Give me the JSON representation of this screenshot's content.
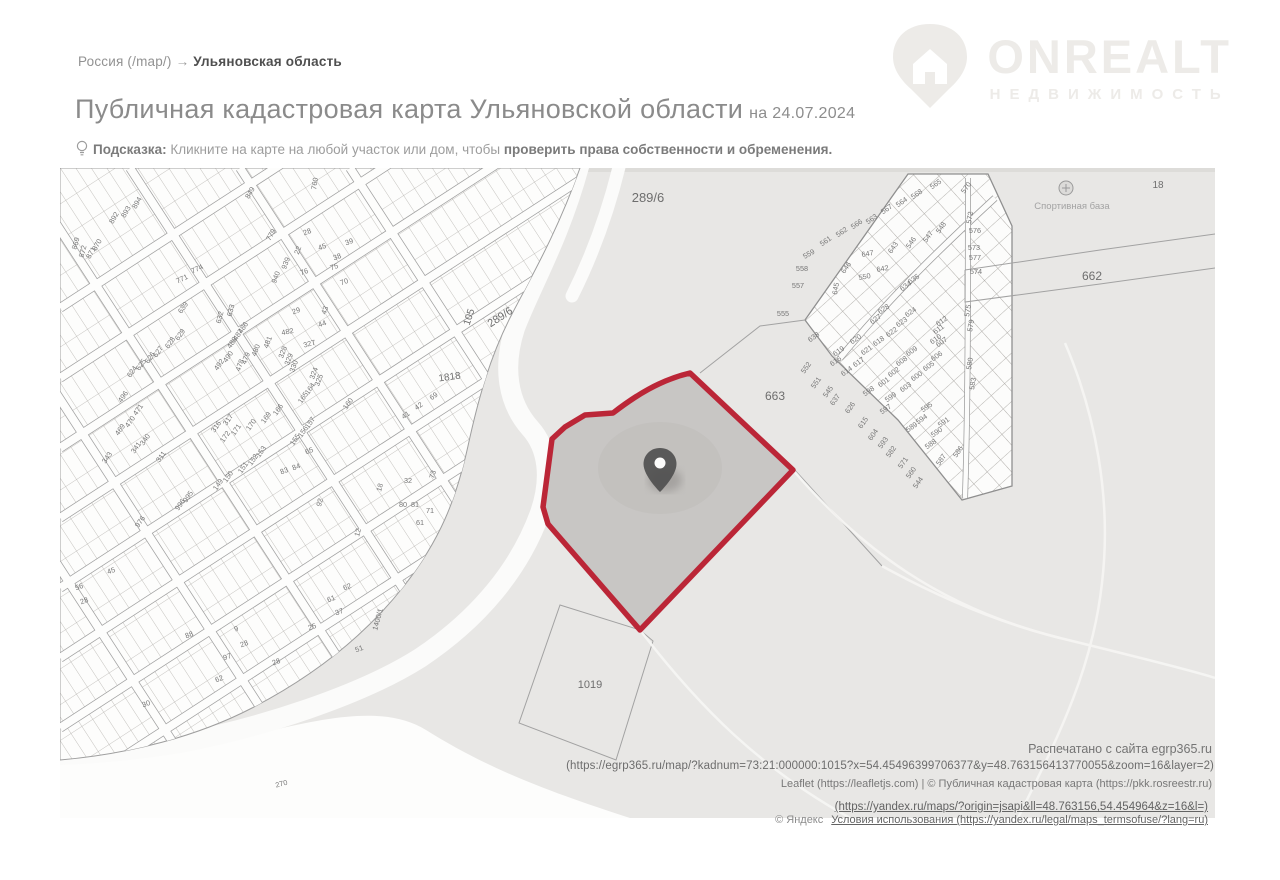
{
  "breadcrumb": {
    "root": "Россия (/map/)",
    "arrow": "→",
    "current": "Ульяновская область"
  },
  "logo": {
    "name": "ONREALT",
    "subtitle": "НЕДВИЖИМОСТЬ",
    "color": "#edebe8"
  },
  "title": {
    "main": "Публичная кадастровая карта Ульяновской области",
    "date_suffix": "на 24.07.2024"
  },
  "hint": {
    "label": "Подсказка:",
    "text_regular": " Кликните на карте на любой участок или дом, чтобы ",
    "text_bold": "проверить права собственности и обременения."
  },
  "map": {
    "colors": {
      "highlight_stroke": "#bb2637",
      "highlight_fill": "#c8c6c4",
      "field_gray": "#e8e7e5",
      "line_gray": "#a8a8a8",
      "label_gray": "#767676"
    },
    "footer": {
      "printed": "Распечатано с сайта egrp365.ru",
      "url": "(https://egrp365.ru/map/?kadnum=73:21:000000:1015?x=54.45496399706377&y=48.763156413770055&zoom=16&layer=2)",
      "leaflet": "Leaflet (https://leafletjs.com) | © Публичная кадастровая карта (https://pkk.rosreestr.ru)"
    },
    "labels_large": [
      {
        "t": "289/6",
        "x": 588,
        "y": 34,
        "s": 13
      },
      {
        "t": "289/6",
        "x": 442,
        "y": 152,
        "s": 11,
        "r": -33
      },
      {
        "t": "105",
        "x": 412,
        "y": 150,
        "s": 10,
        "r": -72
      },
      {
        "t": "1818",
        "x": 390,
        "y": 212,
        "s": 10,
        "r": -8
      },
      {
        "t": "663",
        "x": 715,
        "y": 232,
        "s": 12
      },
      {
        "t": "662",
        "x": 1032,
        "y": 112,
        "s": 12
      },
      {
        "t": "1019",
        "x": 530,
        "y": 520,
        "s": 11
      },
      {
        "t": "18",
        "x": 1098,
        "y": 20,
        "s": 10
      },
      {
        "t": "Спортивная база",
        "x": 1012,
        "y": 41,
        "s": 9.5,
        "c": "#a3a3a3"
      }
    ],
    "parcel_labels": [
      {
        "t": "894",
        "x": 79,
        "y": 36,
        "r": -60
      },
      {
        "t": "893",
        "x": 68,
        "y": 45,
        "r": -60
      },
      {
        "t": "892",
        "x": 56,
        "y": 51,
        "r": -60
      },
      {
        "t": "870",
        "x": 39,
        "y": 78,
        "r": -60
      },
      {
        "t": "871",
        "x": 33,
        "y": 86,
        "r": -60
      },
      {
        "t": "872",
        "x": 25,
        "y": 84,
        "r": -75
      },
      {
        "t": "869",
        "x": 18,
        "y": 76,
        "r": -75
      },
      {
        "t": "849",
        "x": 192,
        "y": 26,
        "r": -60
      },
      {
        "t": "779",
        "x": 213,
        "y": 68,
        "r": -60
      },
      {
        "t": "760",
        "x": 257,
        "y": 16,
        "r": -80
      },
      {
        "t": "774",
        "x": 138,
        "y": 103,
        "r": -25
      },
      {
        "t": "771",
        "x": 123,
        "y": 113,
        "r": -25
      },
      {
        "t": "639",
        "x": 125,
        "y": 141,
        "r": -55
      },
      {
        "t": "633",
        "x": 173,
        "y": 143,
        "r": -75
      },
      {
        "t": "632",
        "x": 162,
        "y": 150,
        "r": -75
      },
      {
        "t": "486",
        "x": 185,
        "y": 161,
        "r": -55
      },
      {
        "t": "487",
        "x": 180,
        "y": 168,
        "r": -55
      },
      {
        "t": "488",
        "x": 174,
        "y": 176,
        "r": -55
      },
      {
        "t": "629",
        "x": 122,
        "y": 168,
        "r": -55
      },
      {
        "t": "628",
        "x": 112,
        "y": 176,
        "r": -55
      },
      {
        "t": "627",
        "x": 100,
        "y": 185,
        "r": -55
      },
      {
        "t": "626",
        "x": 92,
        "y": 191,
        "r": -55
      },
      {
        "t": "625",
        "x": 83,
        "y": 198,
        "r": -55
      },
      {
        "t": "624",
        "x": 74,
        "y": 205,
        "r": -55
      },
      {
        "t": "490",
        "x": 170,
        "y": 190,
        "r": -55
      },
      {
        "t": "492",
        "x": 161,
        "y": 198,
        "r": -55
      },
      {
        "t": "482",
        "x": 228,
        "y": 166,
        "r": -12
      },
      {
        "t": "481",
        "x": 210,
        "y": 175,
        "r": -70
      },
      {
        "t": "480",
        "x": 198,
        "y": 183,
        "r": -70
      },
      {
        "t": "479",
        "x": 188,
        "y": 191,
        "r": -70
      },
      {
        "t": "478",
        "x": 182,
        "y": 198,
        "r": -70
      },
      {
        "t": "327",
        "x": 250,
        "y": 178,
        "r": -15
      },
      {
        "t": "328",
        "x": 225,
        "y": 185,
        "r": -70
      },
      {
        "t": "329",
        "x": 231,
        "y": 192,
        "r": -70
      },
      {
        "t": "330",
        "x": 236,
        "y": 199,
        "r": -70
      },
      {
        "t": "324",
        "x": 256,
        "y": 206,
        "r": -70
      },
      {
        "t": "325",
        "x": 261,
        "y": 213,
        "r": -70
      },
      {
        "t": "939",
        "x": 228,
        "y": 96,
        "r": -70
      },
      {
        "t": "940",
        "x": 218,
        "y": 110,
        "r": -70
      },
      {
        "t": "22",
        "x": 240,
        "y": 83,
        "r": -70
      },
      {
        "t": "28",
        "x": 248,
        "y": 66,
        "r": -20
      },
      {
        "t": "45",
        "x": 263,
        "y": 81,
        "r": -20
      },
      {
        "t": "38",
        "x": 278,
        "y": 91,
        "r": -20
      },
      {
        "t": "39",
        "x": 290,
        "y": 76,
        "r": -20
      },
      {
        "t": "75",
        "x": 275,
        "y": 101,
        "r": -20
      },
      {
        "t": "70",
        "x": 285,
        "y": 116,
        "r": -20
      },
      {
        "t": "76",
        "x": 245,
        "y": 106,
        "r": -20
      },
      {
        "t": "29",
        "x": 237,
        "y": 145,
        "r": -20
      },
      {
        "t": "43",
        "x": 267,
        "y": 143,
        "r": -70
      },
      {
        "t": "44",
        "x": 263,
        "y": 158,
        "r": -20
      },
      {
        "t": "496",
        "x": 65,
        "y": 230,
        "r": -55
      },
      {
        "t": "471",
        "x": 80,
        "y": 243,
        "r": -55
      },
      {
        "t": "470",
        "x": 72,
        "y": 255,
        "r": -55
      },
      {
        "t": "469",
        "x": 62,
        "y": 263,
        "r": -55
      },
      {
        "t": "341",
        "x": 78,
        "y": 281,
        "r": -55
      },
      {
        "t": "340",
        "x": 87,
        "y": 273,
        "r": -55
      },
      {
        "t": "343",
        "x": 49,
        "y": 291,
        "r": -55
      },
      {
        "t": "311",
        "x": 103,
        "y": 290,
        "r": -55
      },
      {
        "t": "317",
        "x": 170,
        "y": 253,
        "r": -55
      },
      {
        "t": "316",
        "x": 158,
        "y": 260,
        "r": -55
      },
      {
        "t": "172",
        "x": 167,
        "y": 270,
        "r": -55
      },
      {
        "t": "171",
        "x": 178,
        "y": 263,
        "r": -55
      },
      {
        "t": "170",
        "x": 193,
        "y": 258,
        "r": -55
      },
      {
        "t": "169",
        "x": 208,
        "y": 251,
        "r": -55
      },
      {
        "t": "166",
        "x": 220,
        "y": 243,
        "r": -55
      },
      {
        "t": "165",
        "x": 245,
        "y": 231,
        "r": -55
      },
      {
        "t": "164",
        "x": 252,
        "y": 222,
        "r": -55
      },
      {
        "t": "160",
        "x": 290,
        "y": 237,
        "r": -55
      },
      {
        "t": "157",
        "x": 252,
        "y": 256,
        "r": -55
      },
      {
        "t": "156",
        "x": 245,
        "y": 265,
        "r": -55
      },
      {
        "t": "155",
        "x": 237,
        "y": 273,
        "r": -55
      },
      {
        "t": "153",
        "x": 203,
        "y": 285,
        "r": -55
      },
      {
        "t": "152",
        "x": 195,
        "y": 293,
        "r": -55
      },
      {
        "t": "151",
        "x": 185,
        "y": 301,
        "r": -55
      },
      {
        "t": "150",
        "x": 170,
        "y": 310,
        "r": -55
      },
      {
        "t": "149",
        "x": 160,
        "y": 318,
        "r": -55
      },
      {
        "t": "995",
        "x": 130,
        "y": 330,
        "r": -55
      },
      {
        "t": "996",
        "x": 122,
        "y": 338,
        "r": -55
      },
      {
        "t": "976",
        "x": 82,
        "y": 355,
        "r": -55
      },
      {
        "t": "83",
        "x": 225,
        "y": 305,
        "r": -20
      },
      {
        "t": "84",
        "x": 237,
        "y": 301,
        "r": -20
      },
      {
        "t": "92",
        "x": 262,
        "y": 335,
        "r": -75
      },
      {
        "t": "65",
        "x": 250,
        "y": 285,
        "r": -20
      },
      {
        "t": "12",
        "x": 300,
        "y": 365,
        "r": -75
      },
      {
        "t": "18",
        "x": 322,
        "y": 320,
        "r": -75
      },
      {
        "t": "41",
        "x": 347,
        "y": 249,
        "r": -35
      },
      {
        "t": "42",
        "x": 360,
        "y": 240,
        "r": -35
      },
      {
        "t": "69",
        "x": 375,
        "y": 230,
        "r": -35
      },
      {
        "t": "73",
        "x": 375,
        "y": 307,
        "r": -75
      },
      {
        "t": "32",
        "x": 348,
        "y": 315
      },
      {
        "t": "80",
        "x": 343,
        "y": 339
      },
      {
        "t": "81",
        "x": 355,
        "y": 339
      },
      {
        "t": "71",
        "x": 370,
        "y": 345
      },
      {
        "t": "61",
        "x": 360,
        "y": 357
      },
      {
        "t": "45",
        "x": 52,
        "y": 405,
        "r": -20
      },
      {
        "t": "56",
        "x": 20,
        "y": 421,
        "r": -20
      },
      {
        "t": "28",
        "x": 25,
        "y": 435,
        "r": -20
      },
      {
        "t": "62",
        "x": 288,
        "y": 421,
        "r": -20
      },
      {
        "t": "61",
        "x": 272,
        "y": 433,
        "r": -20
      },
      {
        "t": "37",
        "x": 280,
        "y": 446,
        "r": -20
      },
      {
        "t": "25",
        "x": 253,
        "y": 461,
        "r": -20
      },
      {
        "t": "51",
        "x": 300,
        "y": 483,
        "r": -20
      },
      {
        "t": "1400/1",
        "x": 320,
        "y": 452,
        "r": -75
      },
      {
        "t": "97",
        "x": 168,
        "y": 491,
        "r": -20
      },
      {
        "t": "62",
        "x": 160,
        "y": 513,
        "r": -20
      },
      {
        "t": "30",
        "x": 87,
        "y": 538,
        "r": -20
      },
      {
        "t": "28",
        "x": 185,
        "y": 478,
        "r": -20
      },
      {
        "t": "9",
        "x": 177,
        "y": 463,
        "r": -20
      },
      {
        "t": "28",
        "x": 217,
        "y": 496,
        "r": -20
      },
      {
        "t": "88",
        "x": 130,
        "y": 469,
        "r": -20
      },
      {
        "t": "270",
        "x": 222,
        "y": 618,
        "r": -15
      },
      {
        "t": "565",
        "x": 877,
        "y": 18,
        "r": -35
      },
      {
        "t": "568",
        "x": 858,
        "y": 28,
        "r": -35
      },
      {
        "t": "564",
        "x": 843,
        "y": 36,
        "r": -35
      },
      {
        "t": "567",
        "x": 828,
        "y": 43,
        "r": -35
      },
      {
        "t": "563",
        "x": 813,
        "y": 53,
        "r": -35
      },
      {
        "t": "566",
        "x": 798,
        "y": 58,
        "r": -35
      },
      {
        "t": "562",
        "x": 783,
        "y": 66,
        "r": -35
      },
      {
        "t": "561",
        "x": 767,
        "y": 75,
        "r": -35
      },
      {
        "t": "559",
        "x": 750,
        "y": 88,
        "r": -30
      },
      {
        "t": "558",
        "x": 742,
        "y": 103
      },
      {
        "t": "557",
        "x": 738,
        "y": 120
      },
      {
        "t": "555",
        "x": 723,
        "y": 148
      },
      {
        "t": "548",
        "x": 883,
        "y": 61,
        "r": -55
      },
      {
        "t": "547",
        "x": 870,
        "y": 70,
        "r": -55
      },
      {
        "t": "546",
        "x": 853,
        "y": 76,
        "r": -55
      },
      {
        "t": "643",
        "x": 835,
        "y": 81,
        "r": -55
      },
      {
        "t": "647",
        "x": 808,
        "y": 88,
        "r": -10
      },
      {
        "t": "646",
        "x": 788,
        "y": 101,
        "r": -55
      },
      {
        "t": "642",
        "x": 823,
        "y": 103,
        "r": -10
      },
      {
        "t": "550",
        "x": 805,
        "y": 111,
        "r": -10
      },
      {
        "t": "645",
        "x": 778,
        "y": 121,
        "r": -80
      },
      {
        "t": "635",
        "x": 855,
        "y": 113,
        "r": -35
      },
      {
        "t": "634",
        "x": 847,
        "y": 120,
        "r": -35
      },
      {
        "t": "628",
        "x": 825,
        "y": 143,
        "r": -35
      },
      {
        "t": "624",
        "x": 852,
        "y": 146,
        "r": -35
      },
      {
        "t": "623",
        "x": 843,
        "y": 156,
        "r": -35
      },
      {
        "t": "627",
        "x": 817,
        "y": 153,
        "r": -35
      },
      {
        "t": "622",
        "x": 833,
        "y": 166,
        "r": -35
      },
      {
        "t": "620",
        "x": 797,
        "y": 173,
        "r": -35
      },
      {
        "t": "621",
        "x": 808,
        "y": 184,
        "r": -35
      },
      {
        "t": "612",
        "x": 883,
        "y": 155,
        "r": -35
      },
      {
        "t": "611",
        "x": 880,
        "y": 163,
        "r": -35
      },
      {
        "t": "610",
        "x": 877,
        "y": 173,
        "r": -35
      },
      {
        "t": "638",
        "x": 755,
        "y": 171,
        "r": -35
      },
      {
        "t": "570",
        "x": 908,
        "y": 21,
        "r": -55
      },
      {
        "t": "572",
        "x": 912,
        "y": 50,
        "r": -80
      },
      {
        "t": "576",
        "x": 915,
        "y": 65
      },
      {
        "t": "573",
        "x": 914,
        "y": 82
      },
      {
        "t": "577",
        "x": 915,
        "y": 92
      },
      {
        "t": "574",
        "x": 916,
        "y": 106
      },
      {
        "t": "575",
        "x": 910,
        "y": 143,
        "r": -80
      },
      {
        "t": "579",
        "x": 913,
        "y": 158,
        "r": -80
      },
      {
        "t": "580",
        "x": 912,
        "y": 196,
        "r": -80
      },
      {
        "t": "583",
        "x": 915,
        "y": 216,
        "r": -80
      },
      {
        "t": "616",
        "x": 777,
        "y": 195,
        "r": -35
      },
      {
        "t": "617",
        "x": 800,
        "y": 196,
        "r": -35
      },
      {
        "t": "619",
        "x": 780,
        "y": 185,
        "r": -35
      },
      {
        "t": "618",
        "x": 820,
        "y": 175,
        "r": -35
      },
      {
        "t": "614",
        "x": 788,
        "y": 205,
        "r": -35
      },
      {
        "t": "609",
        "x": 853,
        "y": 185,
        "r": -35
      },
      {
        "t": "608",
        "x": 843,
        "y": 195,
        "r": -35
      },
      {
        "t": "602",
        "x": 835,
        "y": 206,
        "r": -35
      },
      {
        "t": "601",
        "x": 825,
        "y": 216,
        "r": -35
      },
      {
        "t": "600",
        "x": 858,
        "y": 210,
        "r": -35
      },
      {
        "t": "603",
        "x": 847,
        "y": 221,
        "r": -35
      },
      {
        "t": "605",
        "x": 870,
        "y": 200,
        "r": -35
      },
      {
        "t": "606",
        "x": 878,
        "y": 190,
        "r": -35
      },
      {
        "t": "607",
        "x": 883,
        "y": 176,
        "r": -35
      },
      {
        "t": "598",
        "x": 810,
        "y": 225,
        "r": -35
      },
      {
        "t": "599",
        "x": 832,
        "y": 231,
        "r": -35
      },
      {
        "t": "597",
        "x": 827,
        "y": 243,
        "r": -35
      },
      {
        "t": "595",
        "x": 868,
        "y": 241,
        "r": -35
      },
      {
        "t": "594",
        "x": 863,
        "y": 253,
        "r": -35
      },
      {
        "t": "589",
        "x": 853,
        "y": 261,
        "r": -35
      },
      {
        "t": "588",
        "x": 872,
        "y": 278,
        "r": -35
      },
      {
        "t": "590",
        "x": 878,
        "y": 266,
        "r": -35
      },
      {
        "t": "591",
        "x": 885,
        "y": 256,
        "r": -35
      },
      {
        "t": "552",
        "x": 748,
        "y": 201,
        "r": -55
      },
      {
        "t": "551",
        "x": 758,
        "y": 216,
        "r": -55
      },
      {
        "t": "545",
        "x": 770,
        "y": 225,
        "r": -55
      },
      {
        "t": "637",
        "x": 777,
        "y": 233,
        "r": -55
      },
      {
        "t": "626",
        "x": 792,
        "y": 241,
        "r": -55
      },
      {
        "t": "615",
        "x": 805,
        "y": 256,
        "r": -55
      },
      {
        "t": "604",
        "x": 815,
        "y": 268,
        "r": -55
      },
      {
        "t": "593",
        "x": 825,
        "y": 276,
        "r": -55
      },
      {
        "t": "582",
        "x": 833,
        "y": 285,
        "r": -55
      },
      {
        "t": "571",
        "x": 845,
        "y": 296,
        "r": -55
      },
      {
        "t": "560",
        "x": 853,
        "y": 306,
        "r": -55
      },
      {
        "t": "544",
        "x": 860,
        "y": 316,
        "r": -55
      },
      {
        "t": "587",
        "x": 883,
        "y": 293,
        "r": -55
      },
      {
        "t": "586",
        "x": 900,
        "y": 285,
        "r": -55
      }
    ]
  },
  "attribution": {
    "yandex_url": "(https://yandex.ru/maps/?origin=jsapi&ll=48.763156,54.454964&z=16&l=)",
    "copyright": "© Яндекс",
    "terms": "Условия использования (https://yandex.ru/legal/maps_termsofuse/?lang=ru)"
  }
}
